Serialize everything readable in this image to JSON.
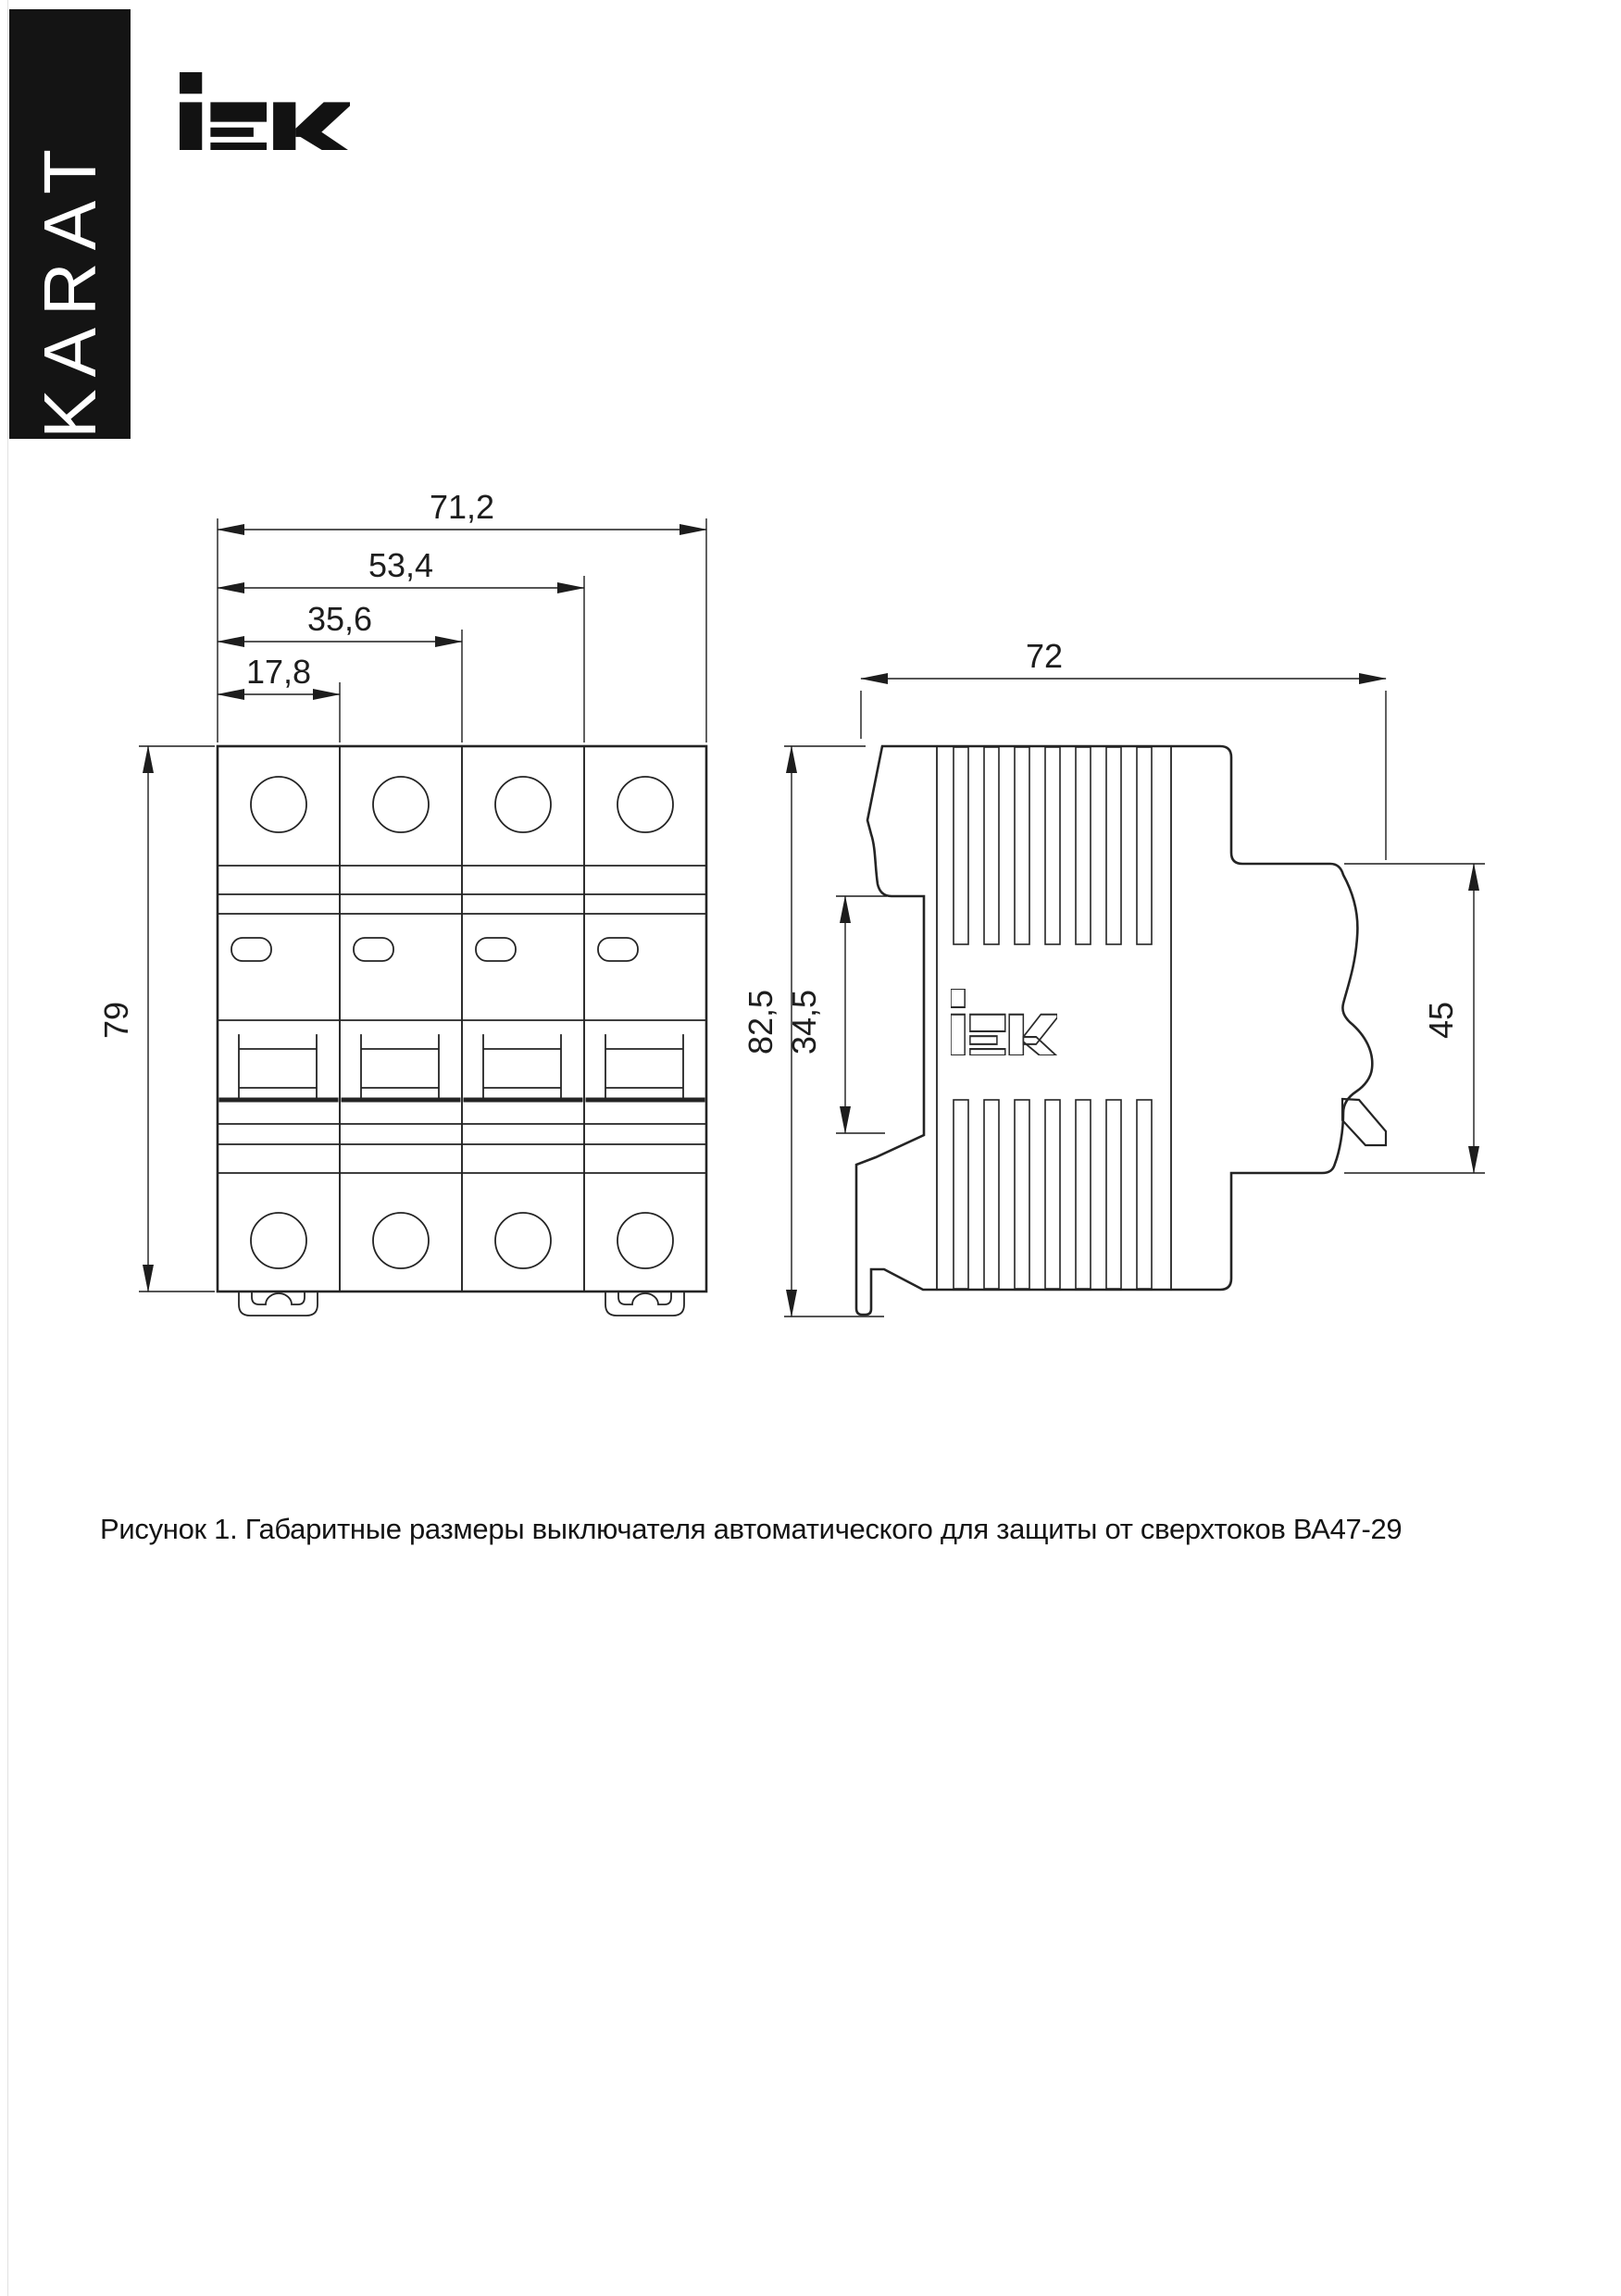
{
  "page": {
    "bg": "#ffffff",
    "line_color": "#242424",
    "edge_line_color": "#e2e2e2"
  },
  "brand": {
    "banner_text": "KARAT",
    "banner_bg": "#141414",
    "banner_text_color": "#ffffff",
    "logo_alt": "IEK"
  },
  "figure": {
    "caption": "Рисунок 1. Габаритные размеры выключателя автоматического для защиты от сверхтоков ВА47-29"
  },
  "views": {
    "front": {
      "label": "front-view",
      "dim_width_total": "71,2",
      "dim_width_3pole": "53,4",
      "dim_width_2pole": "35,6",
      "dim_width_1pole": "17,8",
      "dim_height": "79"
    },
    "side": {
      "label": "side-view",
      "dim_depth": "72",
      "dim_height_total": "82,5",
      "dim_din_recess": "34,5",
      "dim_terminal_zone": "45"
    }
  }
}
